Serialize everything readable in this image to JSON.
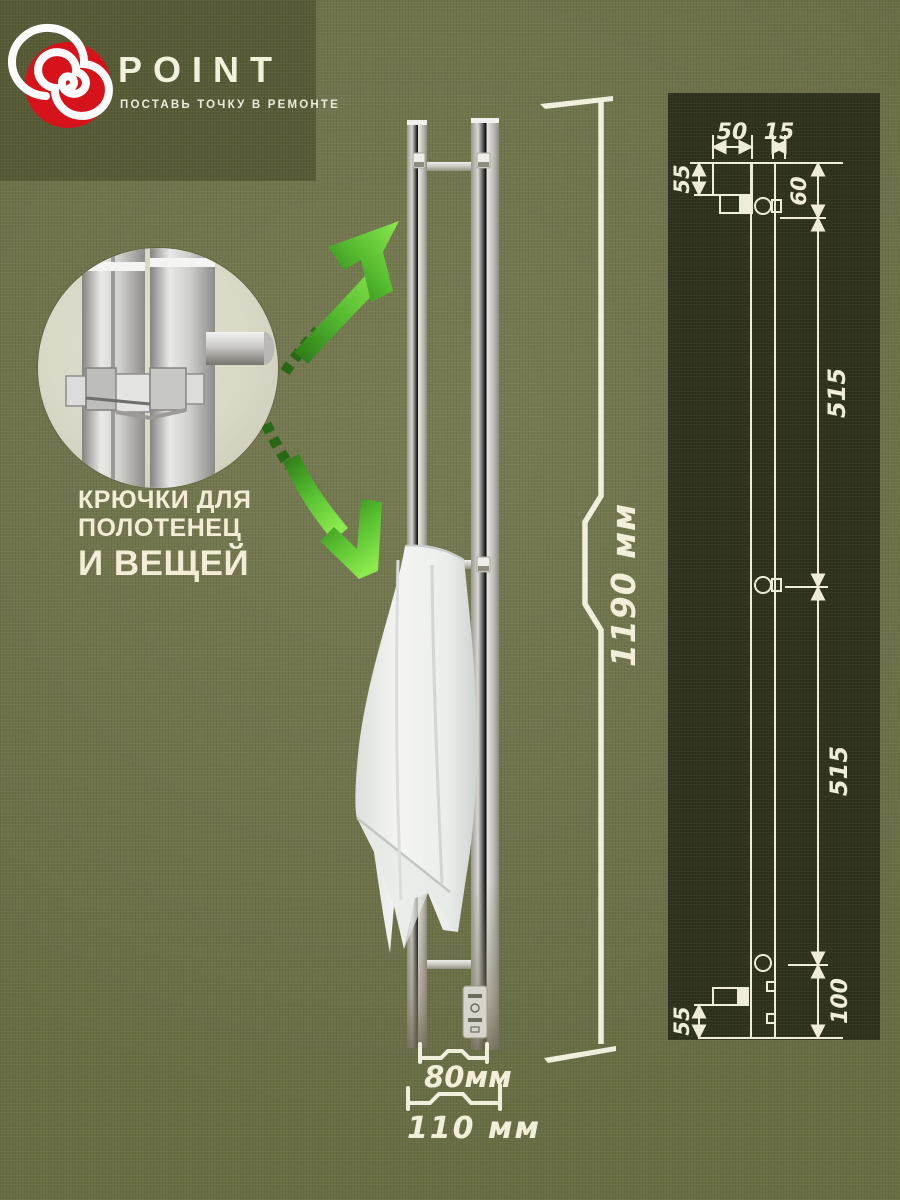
{
  "brand": {
    "name": "POINT",
    "tagline": "ПОСТАВЬ ТОЧКУ В РЕМОНТЕ",
    "logo_icon": "red-spiral",
    "accent_red": "#d6121a"
  },
  "callout": {
    "line1": "КРЮЧКИ ДЛЯ",
    "line2": "ПОЛОТЕНЕЦ",
    "line3": "И ВЕЩЕЙ"
  },
  "dimensions": {
    "overall_height": "1190 мм",
    "bar_spacing": "80мм",
    "overall_width": "110 мм"
  },
  "drawing": {
    "top_width": "50",
    "top_offset": "15",
    "wall_offset_top": "55",
    "hook_offset_top": "60",
    "span_upper": "515",
    "span_lower": "515",
    "bottom_offset": "100",
    "wall_offset_bottom": "55"
  },
  "colors": {
    "background_olive": "#6f7348",
    "logo_panel_olive": "#575b36",
    "drawing_panel": "#2f321d",
    "cream_text": "#f2eed8",
    "arrow_green_bright": "#86e24c",
    "arrow_green_dark": "#236812",
    "metal_light": "#e8e8e5",
    "metal_dark": "#8a8470",
    "towel_white": "#f3f4f2"
  }
}
